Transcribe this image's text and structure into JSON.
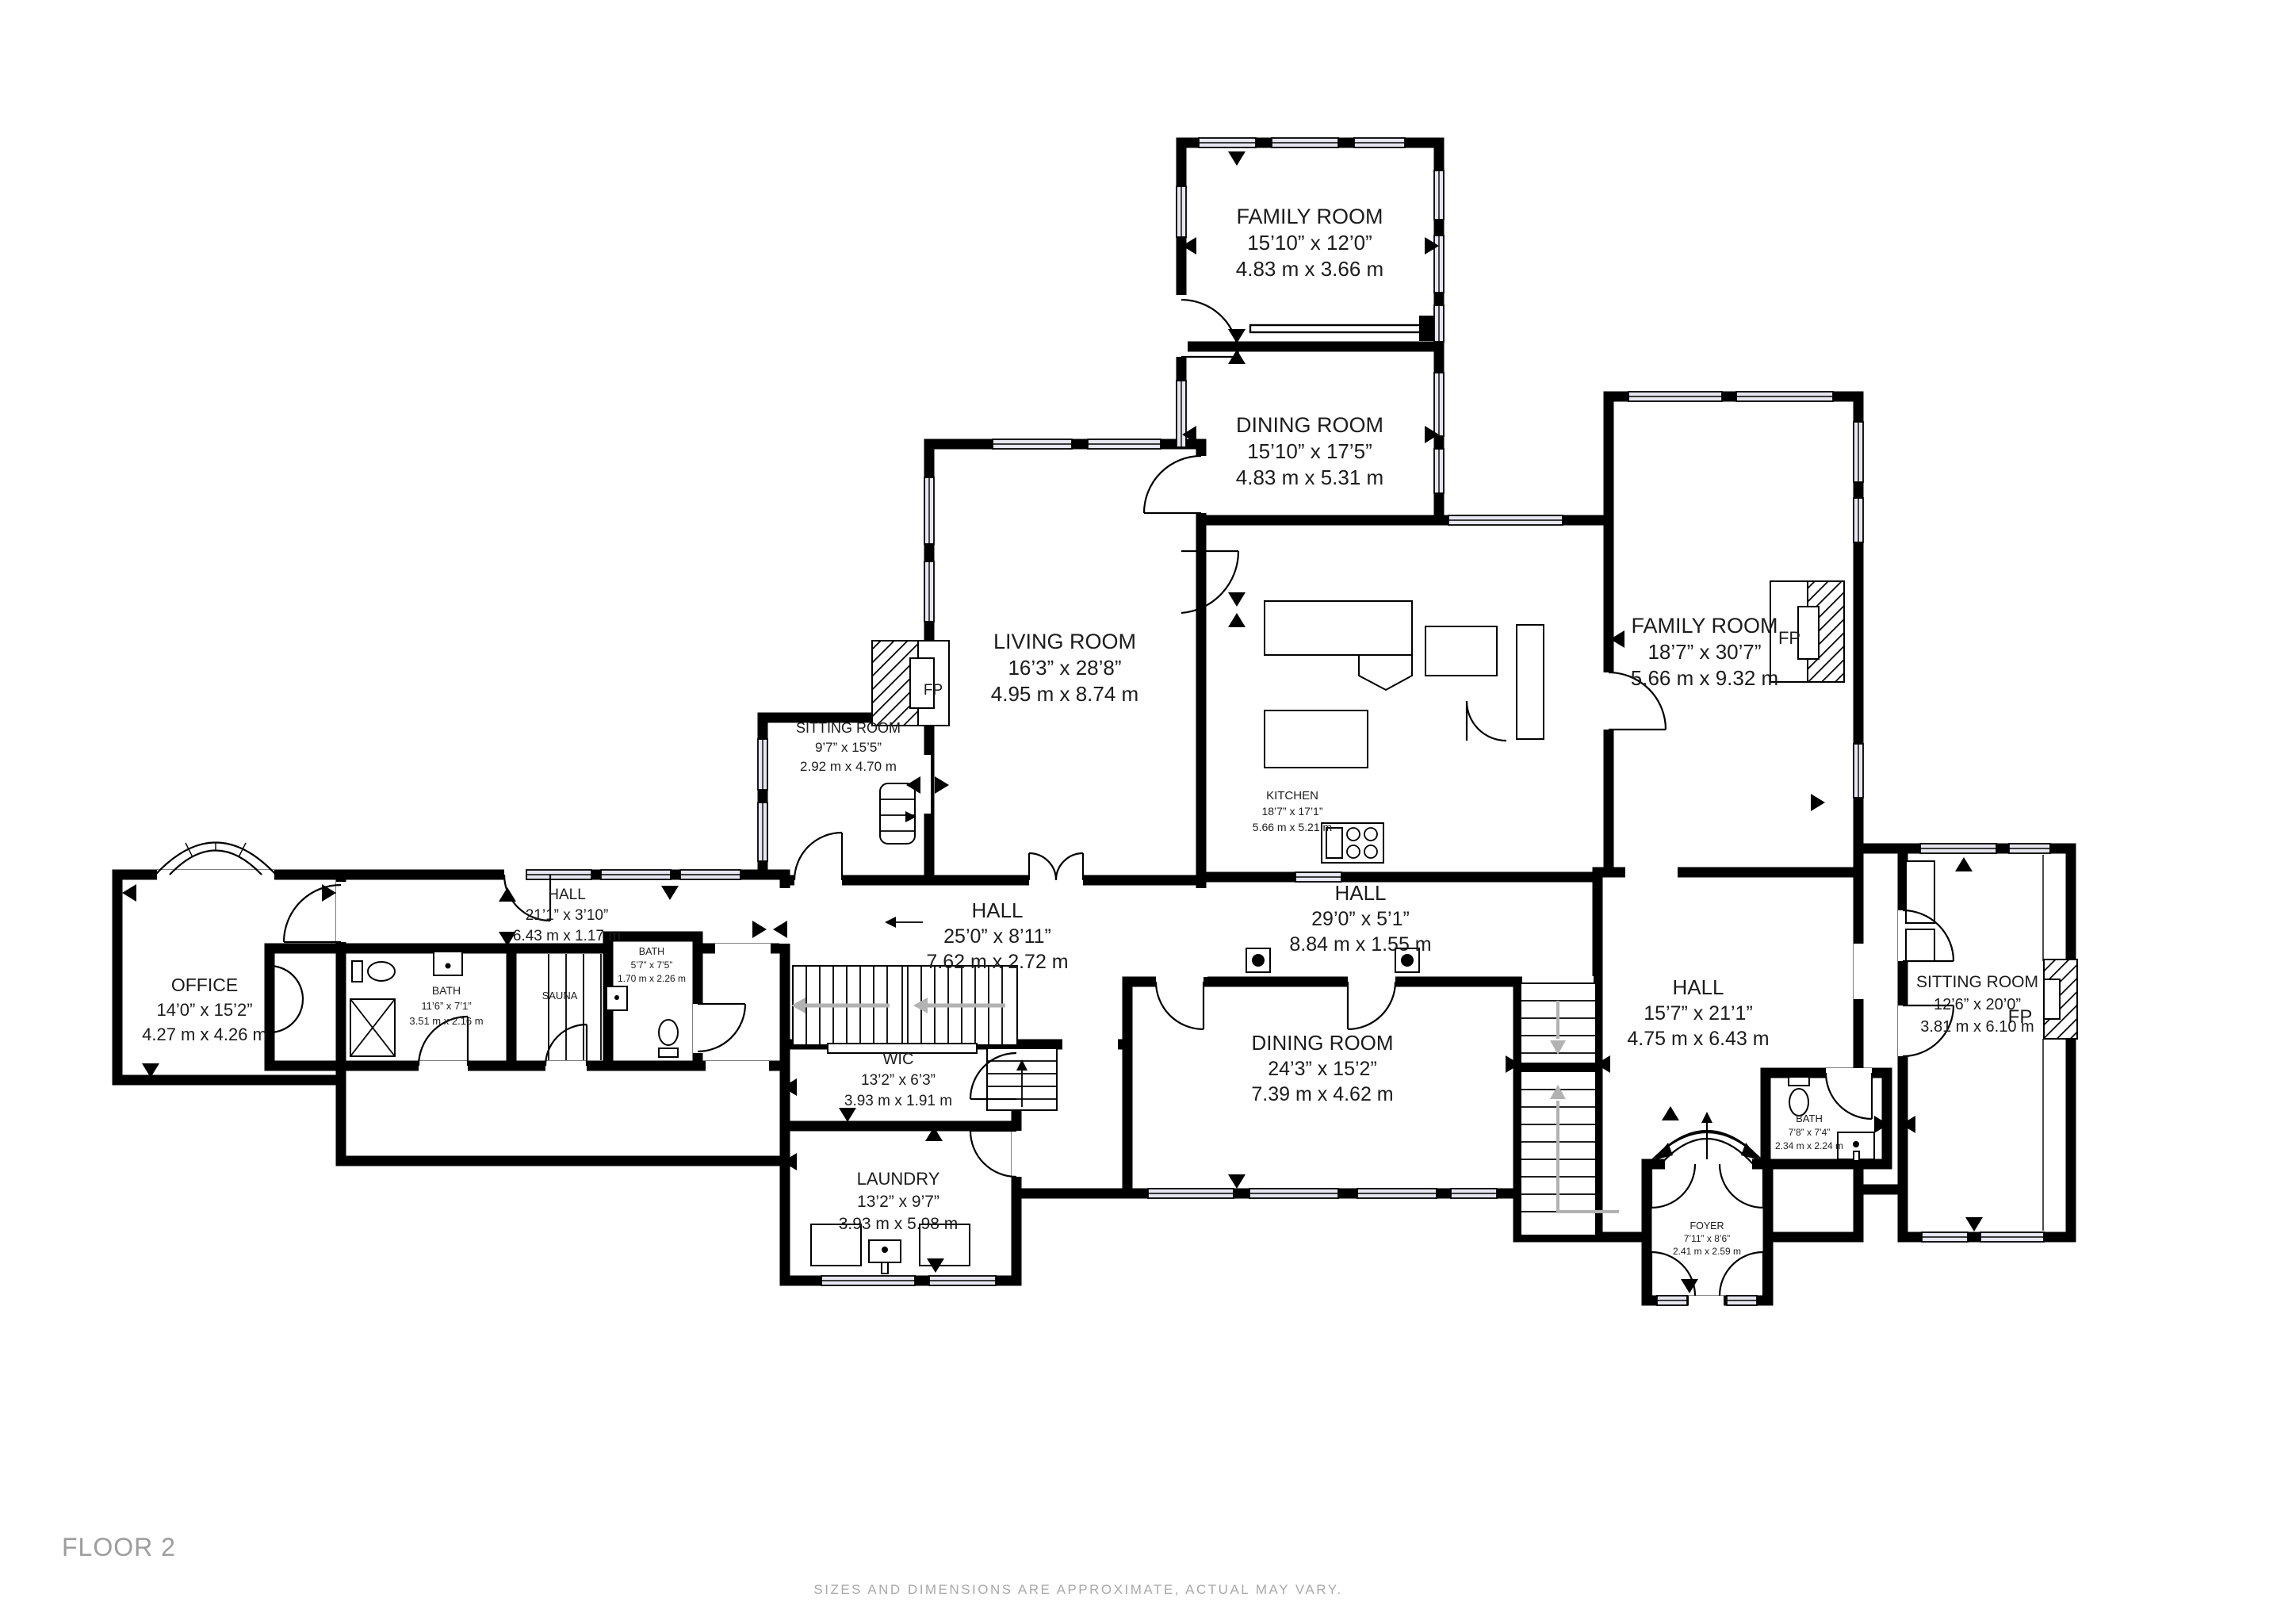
{
  "labels": {
    "fp": "FP"
  },
  "rooms": {
    "family_room_top": {
      "name": "FAMILY ROOM",
      "imperial": "15’10” x 12’0”",
      "metric": "4.83 m x 3.66 m"
    },
    "dining_room_top": {
      "name": "DINING ROOM",
      "imperial": "15’10” x 17’5”",
      "metric": "4.83 m x 5.31 m"
    },
    "living_room": {
      "name": "LIVING ROOM",
      "imperial": "16’3” x 28’8”",
      "metric": "4.95 m x 8.74 m"
    },
    "sitting_room_left": {
      "name": "SITTING ROOM",
      "imperial": "9’7” x 15’5”",
      "metric": "2.92 m x 4.70 m"
    },
    "kitchen": {
      "name": "KITCHEN",
      "imperial": "18’7” x 17’1”",
      "metric": "5.66 m x 5.21 m"
    },
    "family_room_right": {
      "name": "FAMILY ROOM",
      "imperial": "18’7” x 30’7”",
      "metric": "5.66 m x 9.32 m"
    },
    "hall_west": {
      "name": "HALL",
      "imperial": "21’1” x 3’10”",
      "metric": "6.43 m x 1.17 m"
    },
    "hall_center": {
      "name": "HALL",
      "imperial": "25’0” x 8’11”",
      "metric": "7.62 m x 2.72 m"
    },
    "hall_east": {
      "name": "HALL",
      "imperial": "29’0” x 5’1”",
      "metric": "8.84 m x 1.55 m"
    },
    "hall_south": {
      "name": "HALL",
      "imperial": "15’7” x 21’1”",
      "metric": "4.75 m x 6.43 m"
    },
    "office": {
      "name": "OFFICE",
      "imperial": "14’0” x 15’2”",
      "metric": "4.27 m x 4.26 m"
    },
    "bath_big": {
      "name": "BATH",
      "imperial": "11’6” x 7’1”",
      "metric": "3.51 m x 2.16 m"
    },
    "sauna": {
      "name": "SAUNA"
    },
    "bath_small": {
      "name": "BATH",
      "imperial": "5’7” x 7’5”",
      "metric": "1.70 m x 2.26 m"
    },
    "wic": {
      "name": "WIC",
      "imperial": "13’2” x 6’3”",
      "metric": "3.93 m x 1.91 m"
    },
    "laundry": {
      "name": "LAUNDRY",
      "imperial": "13’2” x 9’7”",
      "metric": "3.93 m x 5.98 m"
    },
    "dining_room_south": {
      "name": "DINING ROOM",
      "imperial": "24’3” x 15’2”",
      "metric": "7.39 m x 4.62 m"
    },
    "sitting_room_right": {
      "name": "SITTING ROOM",
      "imperial": "12’6” x 20’0”",
      "metric": "3.81 m x 6.10 m"
    },
    "bath_foyer": {
      "name": "BATH",
      "imperial": "7’8” x 7’4”",
      "metric": "2.34 m x 2.24 m"
    },
    "foyer": {
      "name": "FOYER",
      "imperial": "7’11” x 8’6”",
      "metric": "2.41 m x 2.59 m"
    }
  },
  "footer": {
    "floor_label": "FLOOR 2",
    "disclaimer": "SIZES AND DIMENSIONS ARE APPROXIMATE, ACTUAL MAY VARY."
  }
}
